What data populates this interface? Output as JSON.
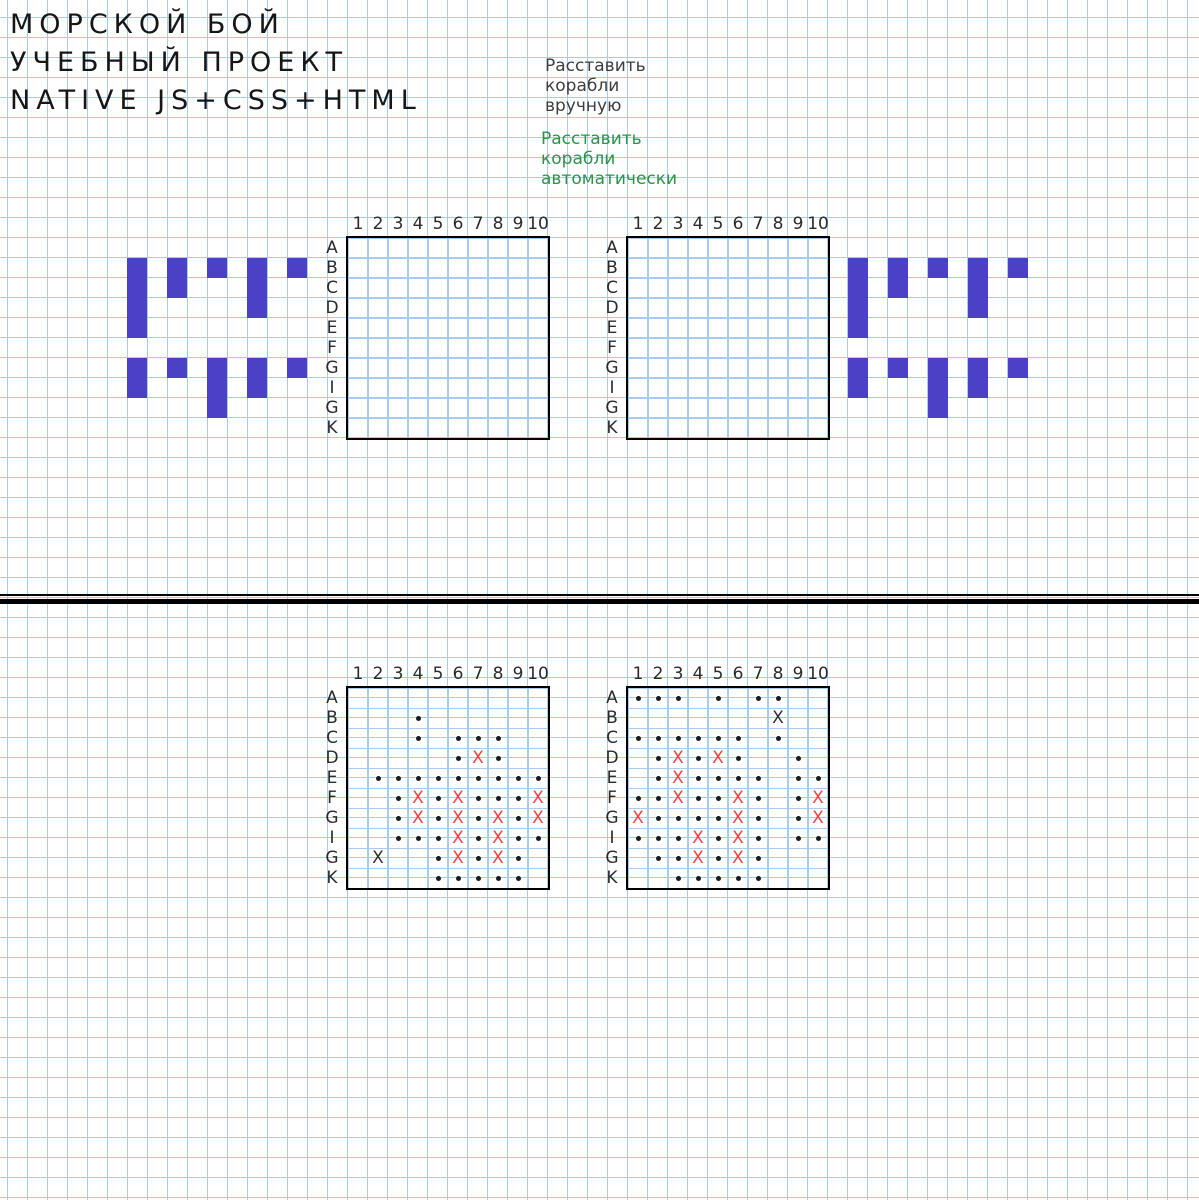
{
  "header": {
    "line1": "МОРСКОЙ БОЙ",
    "line2": "УЧЕБНЫЙ ПРОЕКТ",
    "line3": "NATIVE JS+CSS+HTML"
  },
  "controls": {
    "manual_label": "Расставить корабли вручную",
    "auto_label": "Расставить корабли автоматически"
  },
  "board_labels": {
    "columns": [
      "1",
      "2",
      "3",
      "4",
      "5",
      "6",
      "7",
      "8",
      "9",
      "10"
    ],
    "rows": [
      "A",
      "B",
      "C",
      "D",
      "E",
      "F",
      "G",
      "I",
      "G",
      "K"
    ]
  },
  "colors": {
    "grid_line": "#a6cbf0",
    "ship": "#4b40c6",
    "hit_x": "#ff3b3b",
    "miss_x": "#2e2e2e",
    "miss_dot": "#1b1b1b",
    "auto_link": "#2b9447",
    "manual_link": "#3d3d3d",
    "board_border": "#000000"
  },
  "ships": {
    "cell_px": 20,
    "groups": [
      {
        "x": 127,
        "y": 258,
        "sizes": [
          4,
          2,
          1,
          3,
          1
        ]
      },
      {
        "x": 127,
        "y": 358,
        "sizes": [
          2,
          1,
          3,
          2,
          1
        ]
      },
      {
        "x": 848,
        "y": 258,
        "sizes": [
          4,
          2,
          1,
          3,
          1
        ]
      },
      {
        "x": 848,
        "y": 358,
        "sizes": [
          2,
          1,
          3,
          2,
          1
        ]
      }
    ]
  },
  "boards": [
    {
      "id": "setup-board-left",
      "x": 346,
      "y": 236,
      "marks": []
    },
    {
      "id": "setup-board-right",
      "x": 626,
      "y": 236,
      "marks": []
    },
    {
      "id": "battle-board-left",
      "x": 346,
      "y": 686,
      "marks": [
        "2,4,d",
        "3,4,d",
        "3,6,d",
        "3,7,d",
        "3,8,d",
        "4,6,d",
        "4,7,h",
        "4,8,d",
        "5,2,d",
        "5,3,d",
        "5,4,d",
        "5,5,d",
        "5,6,d",
        "5,7,d",
        "5,8,d",
        "5,9,d",
        "5,10,d",
        "6,3,d",
        "6,4,h",
        "6,5,d",
        "6,6,h",
        "6,7,d",
        "6,8,d",
        "6,9,d",
        "6,10,h",
        "7,3,d",
        "7,4,h",
        "7,5,d",
        "7,6,h",
        "7,7,d",
        "7,8,h",
        "7,9,d",
        "7,10,h",
        "8,3,d",
        "8,4,d",
        "8,5,d",
        "8,6,h",
        "8,7,d",
        "8,8,h",
        "8,9,d",
        "8,10,d",
        "9,2,x",
        "9,5,d",
        "9,6,h",
        "9,7,d",
        "9,8,h",
        "9,9,d",
        "10,5,d",
        "10,6,d",
        "10,7,d",
        "10,8,d",
        "10,9,d"
      ]
    },
    {
      "id": "battle-board-right",
      "x": 626,
      "y": 686,
      "marks": [
        "1,1,d",
        "1,2,d",
        "1,3,d",
        "1,5,d",
        "1,7,d",
        "1,8,d",
        "2,8,x",
        "3,1,d",
        "3,2,d",
        "3,3,d",
        "3,4,d",
        "3,5,d",
        "3,6,d",
        "3,8,d",
        "4,2,d",
        "4,3,h",
        "4,4,d",
        "4,5,h",
        "4,6,d",
        "4,9,d",
        "5,2,d",
        "5,3,h",
        "5,4,d",
        "5,5,d",
        "5,6,d",
        "5,7,d",
        "5,9,d",
        "5,10,d",
        "6,1,d",
        "6,2,d",
        "6,3,h",
        "6,4,d",
        "6,5,d",
        "6,6,h",
        "6,7,d",
        "6,9,d",
        "6,10,h",
        "7,1,h",
        "7,2,d",
        "7,3,d",
        "7,4,d",
        "7,5,d",
        "7,6,h",
        "7,7,d",
        "7,9,d",
        "7,10,h",
        "8,1,d",
        "8,2,d",
        "8,3,d",
        "8,4,h",
        "8,5,d",
        "8,6,h",
        "8,7,d",
        "8,9,d",
        "8,10,d",
        "9,2,d",
        "9,3,d",
        "9,4,h",
        "9,5,d",
        "9,6,h",
        "9,7,d",
        "10,3,d",
        "10,4,d",
        "10,5,d",
        "10,6,d",
        "10,7,d"
      ]
    }
  ]
}
